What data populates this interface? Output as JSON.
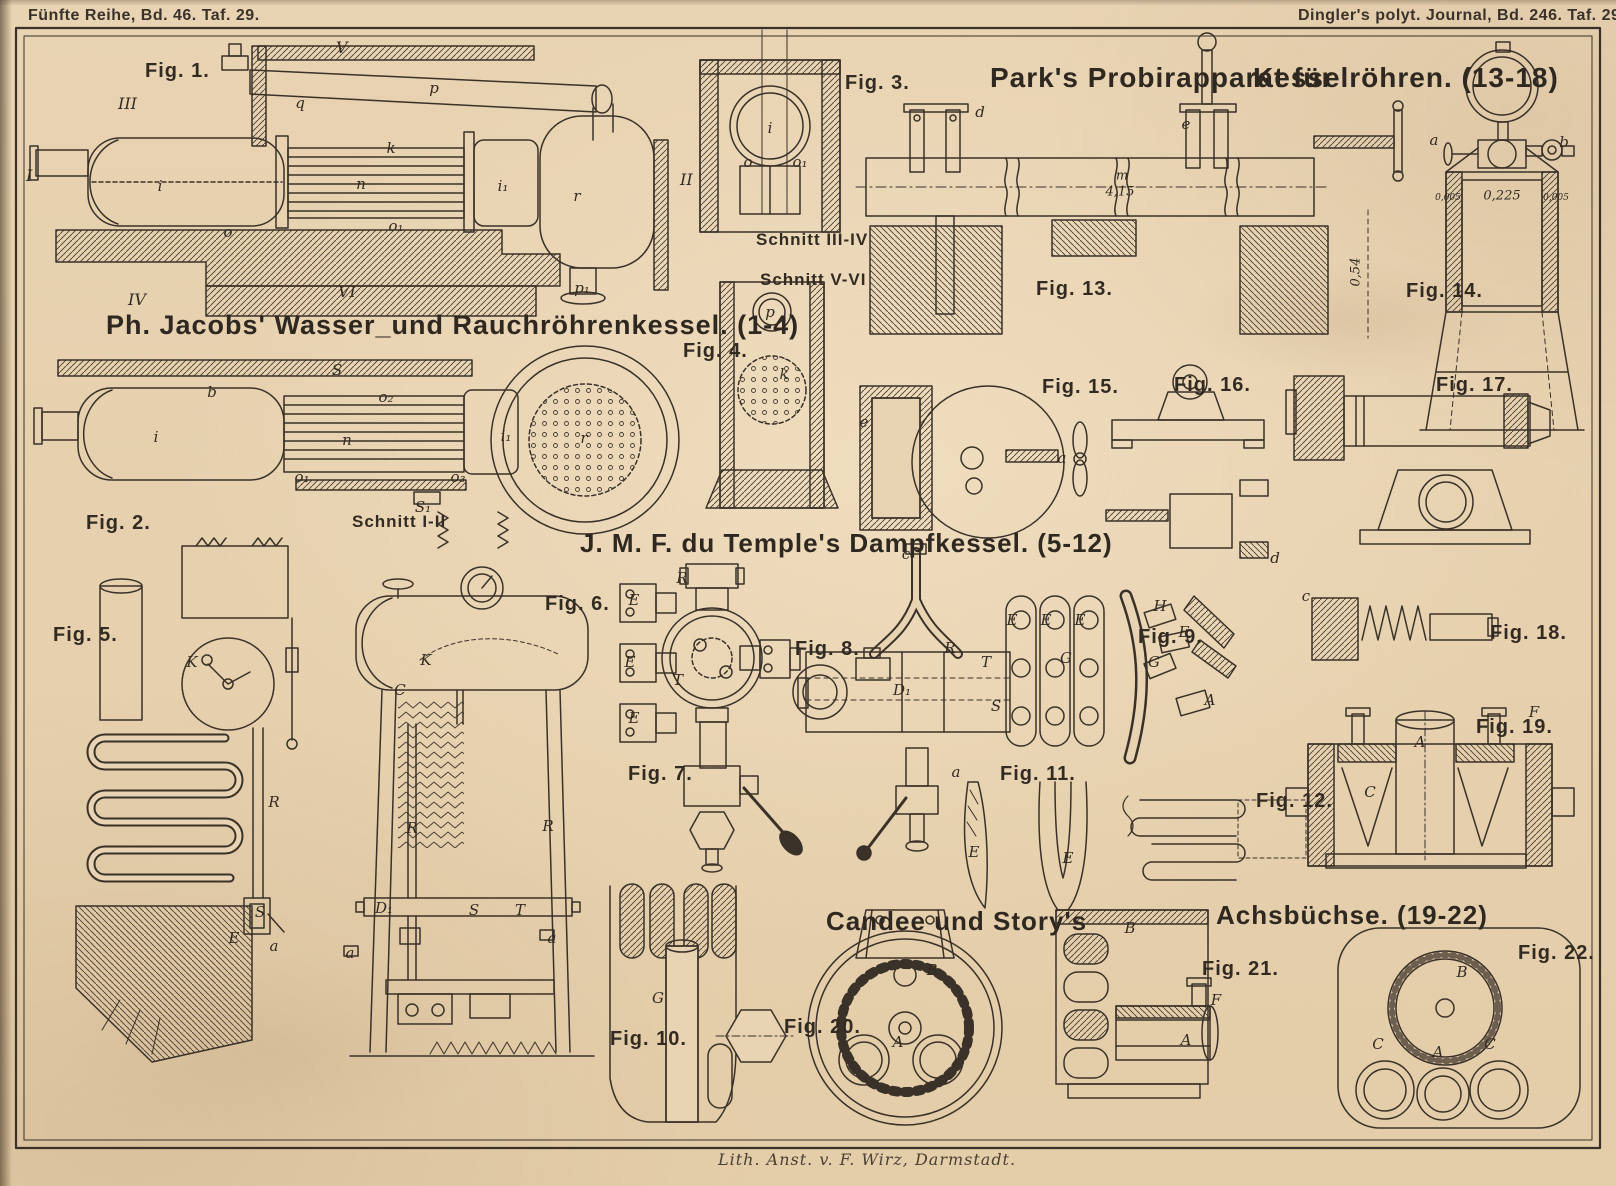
{
  "plate": {
    "header_left": "Fünfte Reihe, Bd. 46. Taf. 29.",
    "header_right": "Dingler's polyt. Journal, Bd. 246. Taf. 29.",
    "imprint": "Lith. Anst. v. F. Wirz, Darmstadt."
  },
  "titles": {
    "jacobs": "Ph. Jacobs' Wasser_und Rauchröhrenkessel. (1-4)",
    "park_a": "Park's Probirapparat für",
    "park_b": "Kesselröhren. (13-18)",
    "temple": "J. M. F. du Temple's Dampfkessel. (5-12)",
    "candee": "Candee und Story's",
    "achsbuechse": "Achsbüchse. (19-22)"
  },
  "figures": [
    {
      "t": "Fig. 1.",
      "x": 145,
      "y": 60
    },
    {
      "t": "Fig. 2.",
      "x": 86,
      "y": 512
    },
    {
      "t": "Fig. 3.",
      "x": 845,
      "y": 72
    },
    {
      "t": "Fig. 4.",
      "x": 683,
      "y": 340
    },
    {
      "t": "Fig. 5.",
      "x": 53,
      "y": 624
    },
    {
      "t": "Fig. 6.",
      "x": 545,
      "y": 593
    },
    {
      "t": "Fig. 7.",
      "x": 628,
      "y": 763
    },
    {
      "t": "Fig. 8.",
      "x": 795,
      "y": 638
    },
    {
      "t": "Fig. 9.",
      "x": 1138,
      "y": 626
    },
    {
      "t": "Fig. 10.",
      "x": 610,
      "y": 1028
    },
    {
      "t": "Fig. 11.",
      "x": 1000,
      "y": 763
    },
    {
      "t": "Fig. 12.",
      "x": 1256,
      "y": 790
    },
    {
      "t": "Fig. 13.",
      "x": 1036,
      "y": 278
    },
    {
      "t": "Fig. 14.",
      "x": 1406,
      "y": 280
    },
    {
      "t": "Fig. 15.",
      "x": 1042,
      "y": 376
    },
    {
      "t": "Fig. 16.",
      "x": 1174,
      "y": 374
    },
    {
      "t": "Fig. 17.",
      "x": 1436,
      "y": 374
    },
    {
      "t": "Fig. 18.",
      "x": 1490,
      "y": 622
    },
    {
      "t": "Fig. 19.",
      "x": 1476,
      "y": 716
    },
    {
      "t": "Fig. 20.",
      "x": 784,
      "y": 1016
    },
    {
      "t": "Fig. 21.",
      "x": 1202,
      "y": 958
    },
    {
      "t": "Fig. 22.",
      "x": 1518,
      "y": 942
    }
  ],
  "section_labels": [
    {
      "t": "Schnitt III-IV",
      "x": 756,
      "y": 230
    },
    {
      "t": "Schnitt V-VI",
      "x": 760,
      "y": 270
    },
    {
      "t": "Schnitt I-II",
      "x": 352,
      "y": 512
    }
  ],
  "ref_marks": [
    {
      "t": "V",
      "x": 336,
      "y": 38
    },
    {
      "t": "III",
      "x": 118,
      "y": 94
    },
    {
      "t": "I",
      "x": 26,
      "y": 166
    },
    {
      "t": "II",
      "x": 680,
      "y": 170
    },
    {
      "t": "IV",
      "x": 128,
      "y": 290
    },
    {
      "t": "VI",
      "x": 338,
      "y": 282
    }
  ],
  "part_labels": [
    {
      "t": "q",
      "x": 300,
      "y": 103
    },
    {
      "t": "p",
      "x": 434,
      "y": 88
    },
    {
      "t": "k",
      "x": 391,
      "y": 148
    },
    {
      "t": "n",
      "x": 361,
      "y": 184
    },
    {
      "t": "i",
      "x": 160,
      "y": 186
    },
    {
      "t": "i₁",
      "x": 503,
      "y": 186
    },
    {
      "t": "r",
      "x": 577,
      "y": 196
    },
    {
      "t": "o",
      "x": 228,
      "y": 232
    },
    {
      "t": "o₁",
      "x": 396,
      "y": 226
    },
    {
      "t": "p₁",
      "x": 582,
      "y": 288
    },
    {
      "t": "S",
      "x": 337,
      "y": 370
    },
    {
      "t": "o₂",
      "x": 386,
      "y": 397
    },
    {
      "t": "b",
      "x": 212,
      "y": 392
    },
    {
      "t": "i",
      "x": 156,
      "y": 437
    },
    {
      "t": "n",
      "x": 347,
      "y": 440
    },
    {
      "t": "i₁",
      "x": 506,
      "y": 436
    },
    {
      "t": "r",
      "x": 584,
      "y": 438
    },
    {
      "t": "o₁",
      "x": 302,
      "y": 477
    },
    {
      "t": "o₃",
      "x": 458,
      "y": 477
    },
    {
      "t": "S₁",
      "x": 423,
      "y": 507
    },
    {
      "t": "i",
      "x": 770,
      "y": 128
    },
    {
      "t": "o",
      "x": 748,
      "y": 162
    },
    {
      "t": "o₁",
      "x": 800,
      "y": 162
    },
    {
      "t": "p",
      "x": 770,
      "y": 312
    },
    {
      "t": "k",
      "x": 784,
      "y": 374
    },
    {
      "t": "d",
      "x": 980,
      "y": 112
    },
    {
      "t": "e",
      "x": 1186,
      "y": 124
    },
    {
      "t": "a",
      "x": 1434,
      "y": 140
    },
    {
      "t": "b",
      "x": 1564,
      "y": 142
    },
    {
      "t": "e",
      "x": 864,
      "y": 422
    },
    {
      "t": "a",
      "x": 1062,
      "y": 458
    },
    {
      "t": "d",
      "x": 1275,
      "y": 558
    },
    {
      "t": "c",
      "x": 1306,
      "y": 596
    },
    {
      "t": "K",
      "x": 192,
      "y": 662
    },
    {
      "t": "R",
      "x": 274,
      "y": 802
    },
    {
      "t": "S",
      "x": 260,
      "y": 912
    },
    {
      "t": "E",
      "x": 234,
      "y": 938
    },
    {
      "t": "a",
      "x": 274,
      "y": 946
    },
    {
      "t": "K",
      "x": 426,
      "y": 660
    },
    {
      "t": "C",
      "x": 400,
      "y": 690
    },
    {
      "t": "R",
      "x": 412,
      "y": 828
    },
    {
      "t": "R",
      "x": 548,
      "y": 826
    },
    {
      "t": "D₁",
      "x": 384,
      "y": 908
    },
    {
      "t": "S",
      "x": 474,
      "y": 910
    },
    {
      "t": "T",
      "x": 520,
      "y": 910
    },
    {
      "t": "a",
      "x": 350,
      "y": 953
    },
    {
      "t": "a",
      "x": 552,
      "y": 938
    },
    {
      "t": "R",
      "x": 682,
      "y": 578
    },
    {
      "t": "E",
      "x": 634,
      "y": 600
    },
    {
      "t": "E",
      "x": 630,
      "y": 662
    },
    {
      "t": "E",
      "x": 634,
      "y": 718
    },
    {
      "t": "T",
      "x": 678,
      "y": 680
    },
    {
      "t": "c",
      "x": 906,
      "y": 554
    },
    {
      "t": "R",
      "x": 950,
      "y": 648
    },
    {
      "t": "T",
      "x": 986,
      "y": 662
    },
    {
      "t": "D₁",
      "x": 902,
      "y": 690
    },
    {
      "t": "S",
      "x": 996,
      "y": 706
    },
    {
      "t": "E",
      "x": 1012,
      "y": 620
    },
    {
      "t": "E",
      "x": 1046,
      "y": 620
    },
    {
      "t": "E",
      "x": 1080,
      "y": 620
    },
    {
      "t": "G",
      "x": 1066,
      "y": 658
    },
    {
      "t": "a",
      "x": 956,
      "y": 772
    },
    {
      "t": "H",
      "x": 1160,
      "y": 606
    },
    {
      "t": "E",
      "x": 1184,
      "y": 632
    },
    {
      "t": "G",
      "x": 1154,
      "y": 662
    },
    {
      "t": "A",
      "x": 1210,
      "y": 700
    },
    {
      "t": "G",
      "x": 658,
      "y": 998
    },
    {
      "t": "E",
      "x": 974,
      "y": 852
    },
    {
      "t": "E",
      "x": 1068,
      "y": 858
    },
    {
      "t": "A",
      "x": 1420,
      "y": 742
    },
    {
      "t": "F",
      "x": 1534,
      "y": 712
    },
    {
      "t": "C",
      "x": 1370,
      "y": 792
    },
    {
      "t": "B",
      "x": 932,
      "y": 970
    },
    {
      "t": "A",
      "x": 898,
      "y": 1042
    },
    {
      "t": "B",
      "x": 1130,
      "y": 928
    },
    {
      "t": "F",
      "x": 1216,
      "y": 1000
    },
    {
      "t": "A",
      "x": 1186,
      "y": 1040
    },
    {
      "t": "B",
      "x": 1462,
      "y": 972
    },
    {
      "t": "C",
      "x": 1378,
      "y": 1044
    },
    {
      "t": "A",
      "x": 1438,
      "y": 1052
    },
    {
      "t": "C",
      "x": 1490,
      "y": 1044
    },
    {
      "t": "m",
      "x": 1122,
      "y": 176,
      "cls": "dim"
    },
    {
      "t": "4,15",
      "x": 1120,
      "y": 192,
      "cls": "dim"
    },
    {
      "t": "0,54",
      "x": 1356,
      "y": 272,
      "cls": "dim rot"
    },
    {
      "t": "0,225",
      "x": 1502,
      "y": 196,
      "cls": "dim"
    },
    {
      "t": "0,005",
      "x": 1448,
      "y": 198,
      "cls": "tiny"
    },
    {
      "t": "0,005",
      "x": 1556,
      "y": 198,
      "cls": "tiny"
    }
  ],
  "colors": {
    "paper": "#e8d3b2",
    "ink": "#332b22"
  }
}
